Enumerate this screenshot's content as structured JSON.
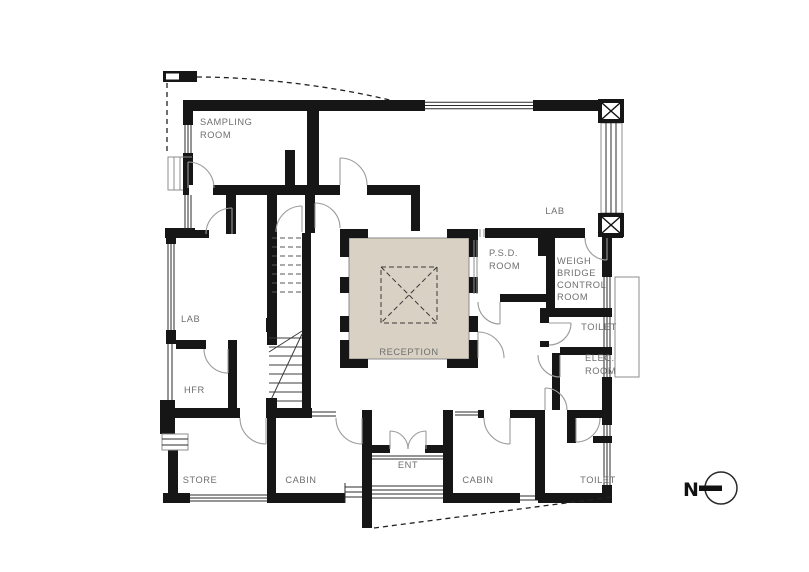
{
  "title": "Floor plan drawing",
  "colors": {
    "wall": "#161616",
    "reception_fill": "#d9d1c3",
    "label_text": "#6f6f6f",
    "line": "#2b2b2b",
    "arc": "#9b9b9b",
    "background": "#ffffff"
  },
  "rooms": {
    "sampling": {
      "line1": "SAMPLING",
      "line2": "ROOM"
    },
    "lab_top": {
      "label": "LAB"
    },
    "psd": {
      "line1": "P.S.D.",
      "line2": "ROOM"
    },
    "weigh_bridge": {
      "line1": "WEIGH",
      "line2": "BRIDGE",
      "line3": "CONTROL",
      "line4": "ROOM"
    },
    "toilet_mid": {
      "label": "TOILET"
    },
    "elec": {
      "line1": "ELEC.",
      "line2": "ROOM"
    },
    "lab_left": {
      "label": "LAB"
    },
    "hfr": {
      "label": "HFR"
    },
    "store": {
      "label": "STORE"
    },
    "cabin_left": {
      "label": "CABIN"
    },
    "ent": {
      "label": "ENT"
    },
    "cabin_right": {
      "label": "CABIN"
    },
    "toilet_bottom": {
      "label": "TOILET"
    },
    "reception": {
      "label": "RECEPTION"
    }
  },
  "compass": {
    "north_label": "N"
  }
}
